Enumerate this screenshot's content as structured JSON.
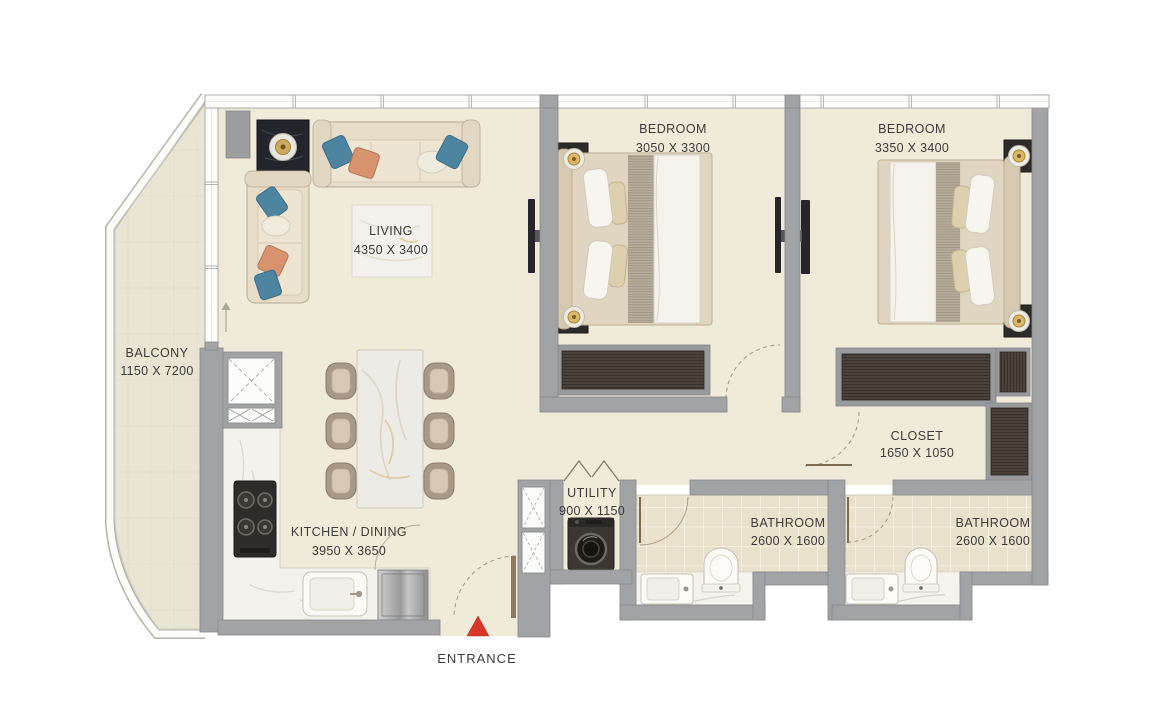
{
  "plan": {
    "rooms": {
      "balcony": {
        "name": "BALCONY",
        "dims": "1150 X 7200"
      },
      "living": {
        "name": "LIVING",
        "dims": "4350 X 3400"
      },
      "bedroom1": {
        "name": "BEDROOM",
        "dims": "3050 X 3300"
      },
      "bedroom2": {
        "name": "BEDROOM",
        "dims": "3350 X 3400"
      },
      "closet": {
        "name": "CLOSET",
        "dims": "1650 X 1050"
      },
      "utility": {
        "name": "UTILITY",
        "dims": "900 X 1150"
      },
      "bathroom1": {
        "name": "BATHROOM",
        "dims": "2600 X 1600"
      },
      "bathroom2": {
        "name": "BATHROOM",
        "dims": "2600 X 1600"
      },
      "kitchen": {
        "name": "KITCHEN / DINING",
        "dims": "3950 X 3650"
      }
    },
    "entrance": {
      "label": "ENTRANCE"
    },
    "colors": {
      "floor": "#f0ead9",
      "balcony_floor": "#e9e5d3",
      "wall": "#a2a3a5",
      "tile": "#eae1cd",
      "wood_dark": "#4a423b",
      "accent_red": "#d8352b",
      "pillow_blue": "#4d84a0",
      "pillow_orange": "#d7936e",
      "label_text": "#3b3b3b"
    }
  }
}
